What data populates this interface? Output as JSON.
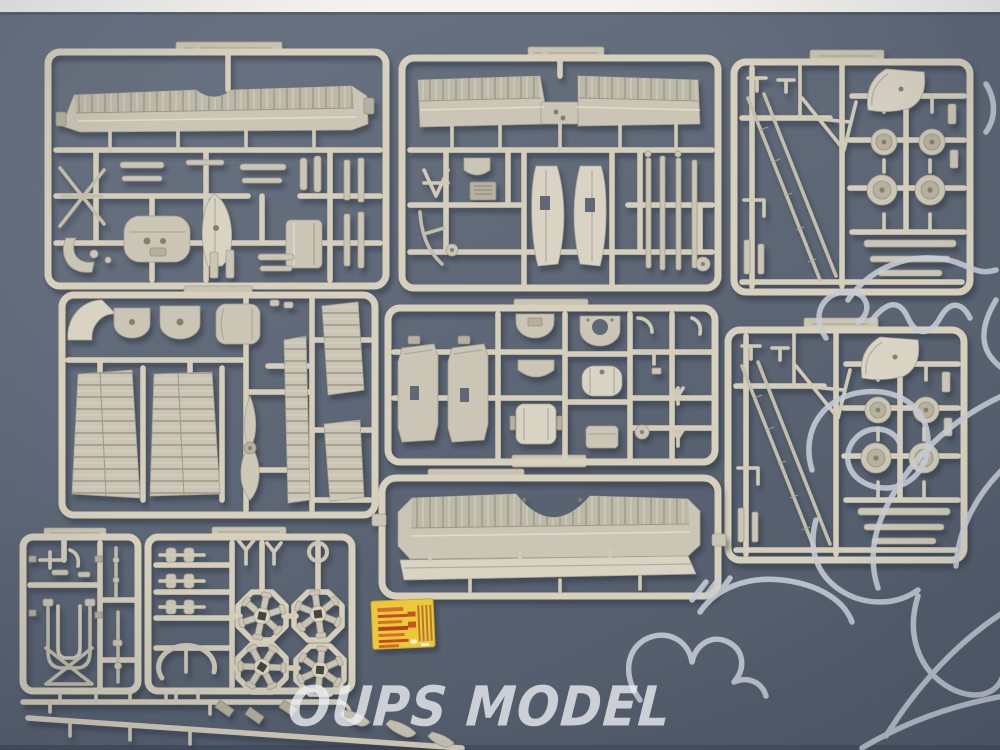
{
  "scene": {
    "type": "product-photograph",
    "subject": "Grey styrene plastic model-kit sprues of a WWI biplane laid out on a blue-grey backdrop, photographed from above",
    "sprue_count": 9,
    "background_color": "#5f6a79",
    "table_edge_color": "#f4f3ef",
    "plastic_color": "#d4ceba"
  },
  "watermark": {
    "text": "OUPS MODEL",
    "color": "#eef1f4"
  },
  "overlay": {
    "description": "hand-drawn white cartoon mascot line-art overlay",
    "color": "#c7ccd5"
  },
  "decal_sheet": {
    "base_color": "#ecc93a",
    "stripe_color": "#d4702c",
    "stripe_color_alt": "#c94a22"
  },
  "sprues": [
    {
      "id": "top-left",
      "main_part": "ribbed upper wing half with nacelle pod, struts and cowling drum"
    },
    {
      "id": "top-center",
      "main_part": "lower wing panels, fuselage nacelle halves, seat and long struts"
    },
    {
      "id": "top-right",
      "main_part": "tail fin, four wheels and tail-boom rods"
    },
    {
      "id": "mid-left",
      "main_part": "wing panels, engine cowl pieces, two-blade propeller, control surfaces"
    },
    {
      "id": "mid-center",
      "main_part": "nacelle side panels, bulkheads, fuel tank and fittings"
    },
    {
      "id": "mid-right",
      "main_part": "second identical tail fin / wheels / boom sprue"
    },
    {
      "id": "bottom-center",
      "main_part": "one-piece ribbed upper wing with centre cut-out and spar strip"
    },
    {
      "id": "bottom-left",
      "main_part": "undercarriage U-frame with cross bracing and rods"
    },
    {
      "id": "bottom-left-2",
      "main_part": "four radial-engine cylinder stars, crankcase ring and manifolds"
    }
  ]
}
